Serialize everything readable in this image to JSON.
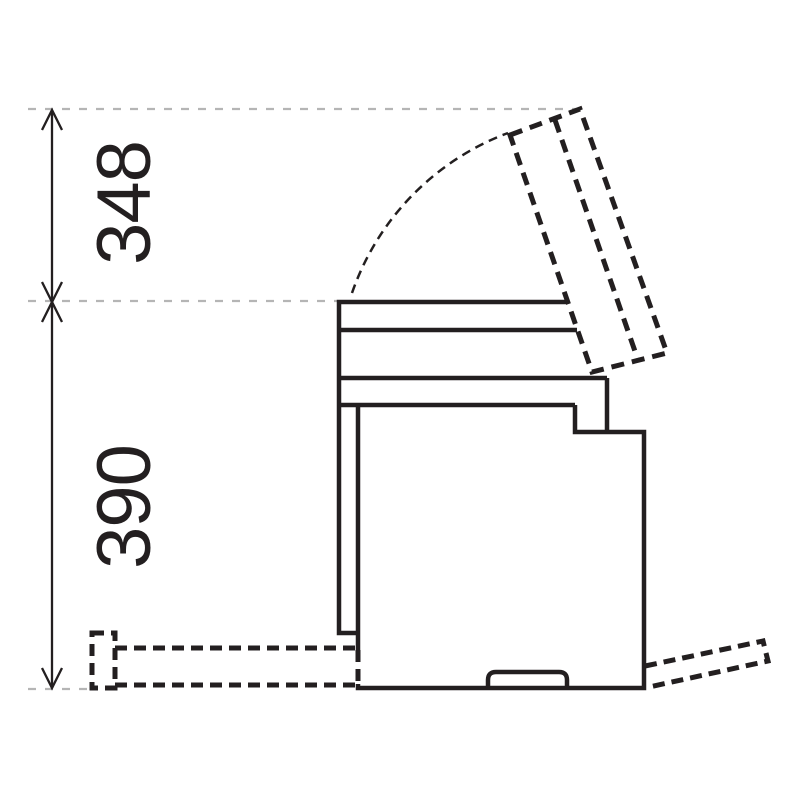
{
  "page": {
    "background": "#ffffff"
  },
  "colors": {
    "line": "#231f20",
    "reference_line": "#b5b5b5"
  },
  "dimensions": {
    "upper_label": "348",
    "lower_label": "390"
  }
}
